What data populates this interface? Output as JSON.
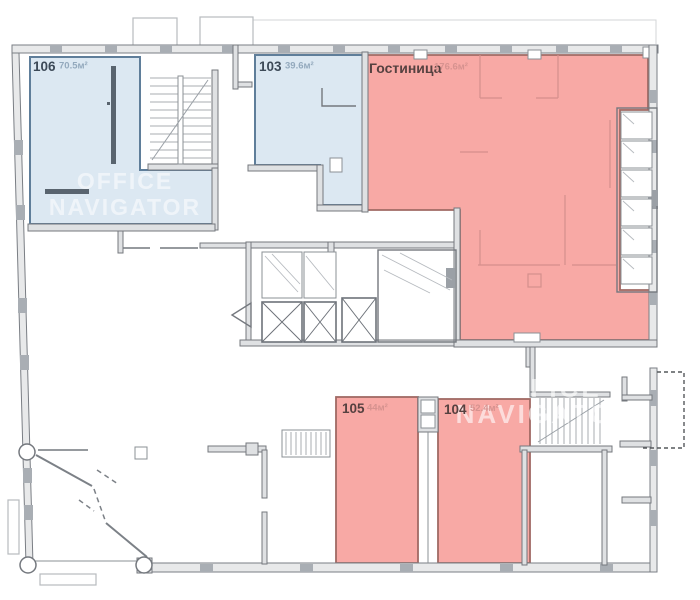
{
  "watermark": {
    "line1": "OFFICE",
    "line2": "NAVIGATOR"
  },
  "colors": {
    "room_blue_fill": "#dce8f2",
    "room_blue_stroke": "#5f7e9a",
    "room_pink_fill": "#f8a9a5",
    "room_pink_stroke": "#a06a64",
    "wall": "#74787e",
    "label_dark_blue": "#3d4a58",
    "label_light_blue": "#93a9bd",
    "label_dark_red": "#564140",
    "label_light_red": "#d6928f"
  },
  "rooms": [
    {
      "id": "106",
      "number": "106",
      "area": "70.5м²",
      "highlight": "blue"
    },
    {
      "id": "103",
      "number": "103",
      "area": "39.6м²",
      "highlight": "blue"
    },
    {
      "id": "hotel",
      "number": "Гостиница",
      "area": "176.6м²",
      "highlight": "pink"
    },
    {
      "id": "105",
      "number": "105",
      "area": "44м²",
      "highlight": "pink"
    },
    {
      "id": "104",
      "number": "104",
      "area": "52.4м²",
      "highlight": "pink"
    }
  ]
}
